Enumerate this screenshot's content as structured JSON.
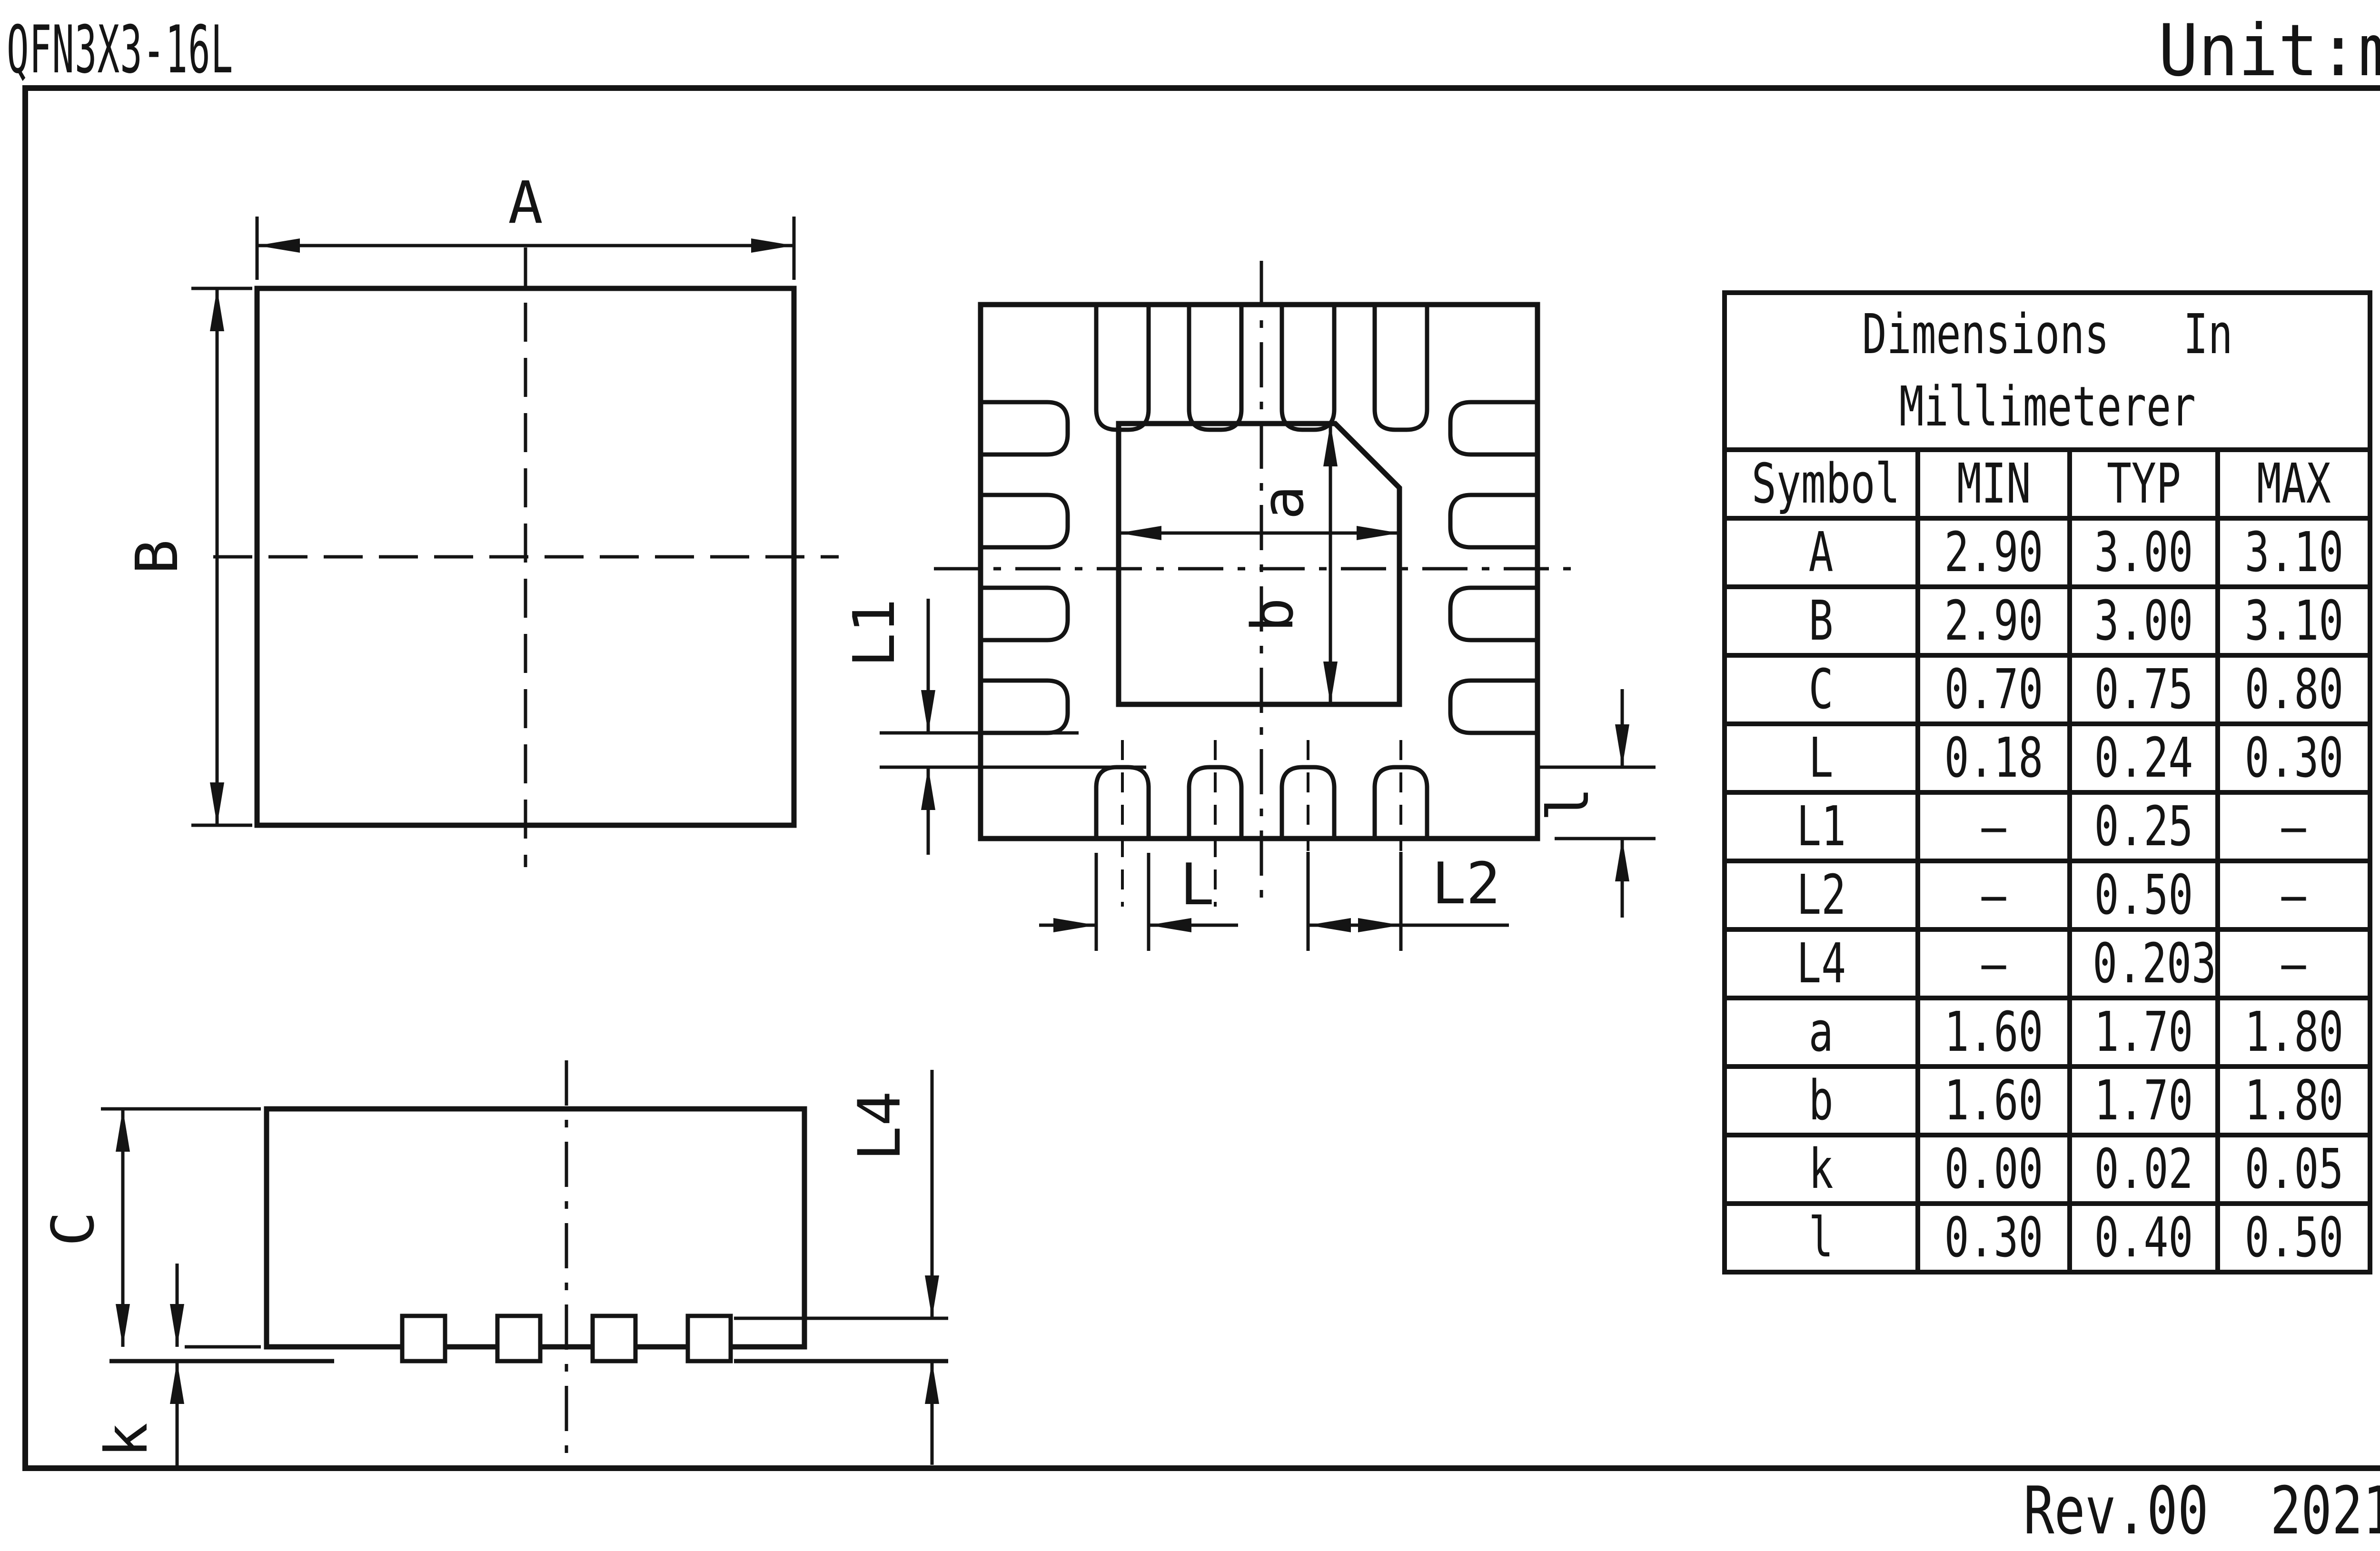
{
  "title": "QFN3X3-16L",
  "unit": "Unit:mm",
  "revision": "Rev.00  202107",
  "table": {
    "title_line1": "Dimensions   In",
    "title_line2": "Millimeterer",
    "headers": {
      "symbol": "Symbol",
      "min": "MIN",
      "typ": "TYP",
      "max": "MAX"
    },
    "rows": [
      {
        "symbol": "A",
        "min": "2.90",
        "typ": "3.00",
        "max": "3.10"
      },
      {
        "symbol": "B",
        "min": "2.90",
        "typ": "3.00",
        "max": "3.10"
      },
      {
        "symbol": "C",
        "min": "0.70",
        "typ": "0.75",
        "max": "0.80"
      },
      {
        "symbol": "L",
        "min": "0.18",
        "typ": "0.24",
        "max": "0.30"
      },
      {
        "symbol": "L1",
        "min": "–",
        "typ": "0.25",
        "max": "–"
      },
      {
        "symbol": "L2",
        "min": "–",
        "typ": "0.50",
        "max": "–"
      },
      {
        "symbol": "L4",
        "min": "–",
        "typ": "0.203",
        "max": "–"
      },
      {
        "symbol": "a",
        "min": "1.60",
        "typ": "1.70",
        "max": "1.80"
      },
      {
        "symbol": "b",
        "min": "1.60",
        "typ": "1.70",
        "max": "1.80"
      },
      {
        "symbol": "k",
        "min": "0.00",
        "typ": "0.02",
        "max": "0.05"
      },
      {
        "symbol": "l",
        "min": "0.30",
        "typ": "0.40",
        "max": "0.50"
      }
    ]
  },
  "dimensions": {
    "A": "A",
    "B": "B",
    "a": "a",
    "b": "b",
    "L": "L",
    "L1": "L1",
    "L2": "L2",
    "L4": "L4",
    "C": "C",
    "k": "k",
    "l": "l"
  },
  "colors": {
    "ink": "#141414",
    "paper": "#ffffff"
  }
}
